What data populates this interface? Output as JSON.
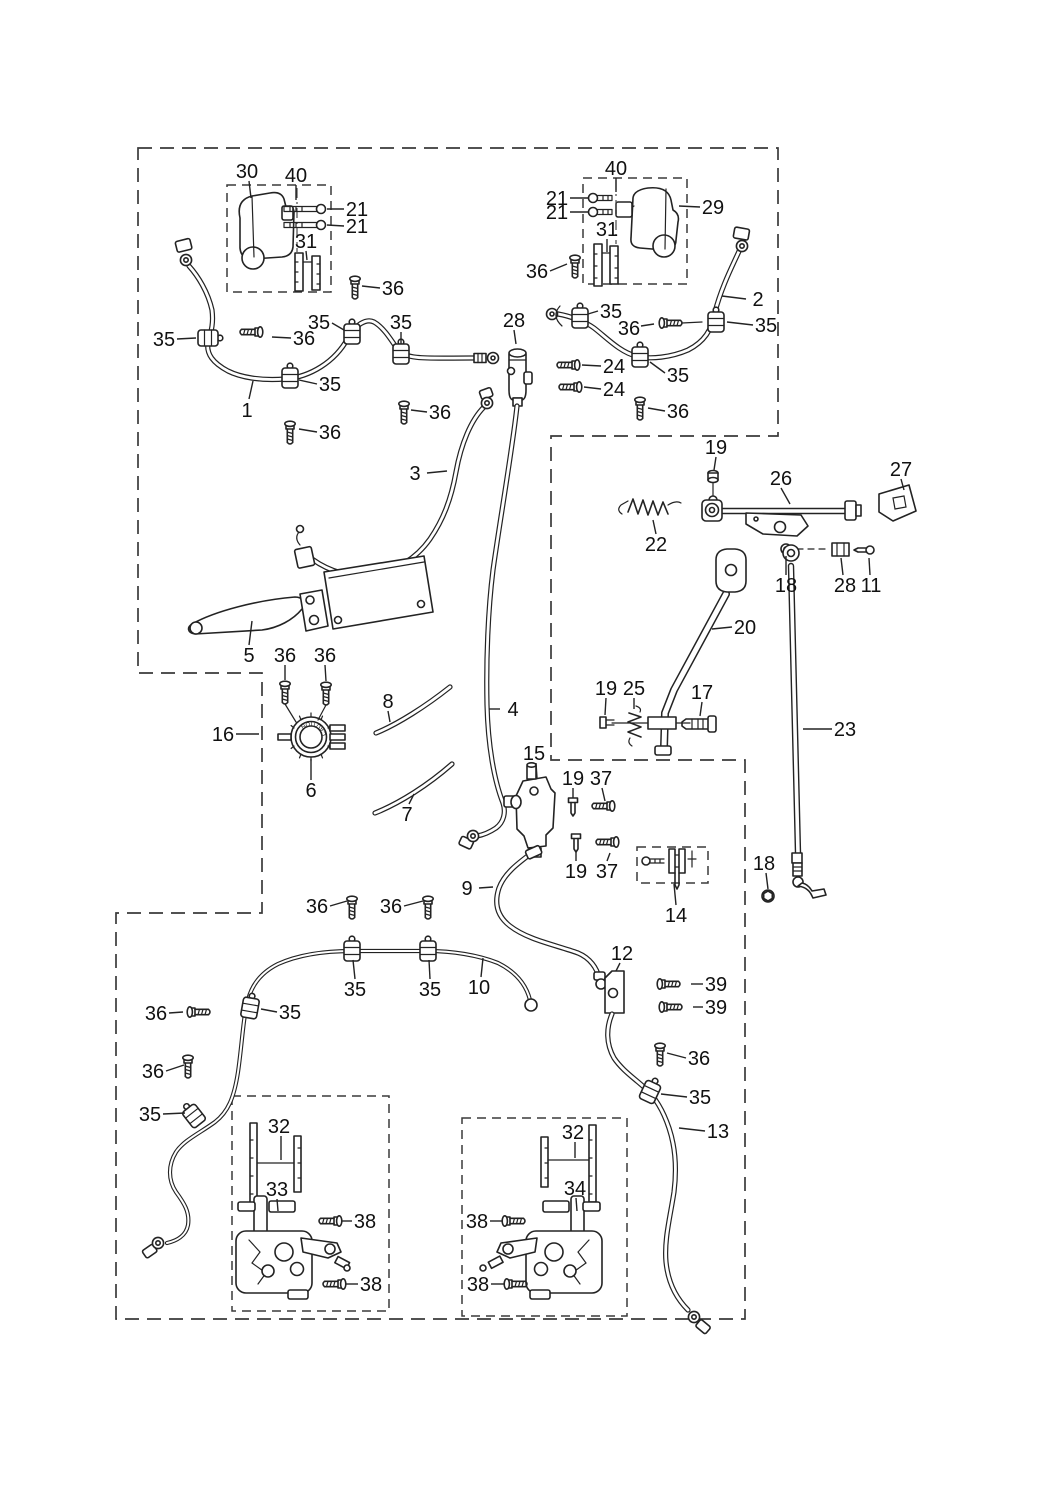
{
  "canvas": {
    "width": 1040,
    "height": 1500,
    "background": "#ffffff",
    "ink": "#232323",
    "label_color": "#111111",
    "label_font_px": 20
  },
  "cap": {
    "text": "CAUTION"
  },
  "callouts": [
    {
      "t": "30",
      "x": 247,
      "y": 171,
      "l": [
        249,
        181,
        251,
        198
      ]
    },
    {
      "t": "40",
      "x": 296,
      "y": 175,
      "l": [
        296,
        185,
        296,
        200
      ]
    },
    {
      "t": "21",
      "x": 357,
      "y": 209,
      "l": [
        344,
        209,
        327,
        209
      ]
    },
    {
      "t": "21",
      "x": 357,
      "y": 226,
      "l": [
        344,
        226,
        327,
        225
      ]
    },
    {
      "t": "31",
      "x": 306,
      "y": 241,
      "l": [
        306,
        251,
        307,
        260
      ]
    },
    {
      "t": "36",
      "x": 393,
      "y": 288,
      "l": [
        380,
        288,
        362,
        286
      ]
    },
    {
      "t": "35",
      "x": 319,
      "y": 322,
      "l": [
        332,
        323,
        344,
        330
      ]
    },
    {
      "t": "35",
      "x": 401,
      "y": 322,
      "l": [
        401,
        332,
        401,
        344
      ]
    },
    {
      "t": "36",
      "x": 440,
      "y": 412,
      "l": [
        427,
        412,
        411,
        410
      ]
    },
    {
      "t": "35",
      "x": 164,
      "y": 339,
      "l": [
        177,
        339,
        196,
        338
      ]
    },
    {
      "t": "36",
      "x": 304,
      "y": 338,
      "l": [
        291,
        338,
        272,
        337
      ]
    },
    {
      "t": "35",
      "x": 330,
      "y": 384,
      "l": [
        317,
        384,
        299,
        380
      ]
    },
    {
      "t": "1",
      "x": 247,
      "y": 410,
      "l": [
        249,
        399,
        253,
        381
      ]
    },
    {
      "t": "36",
      "x": 330,
      "y": 432,
      "l": [
        317,
        432,
        299,
        429
      ]
    },
    {
      "t": "28",
      "x": 514,
      "y": 320,
      "l": [
        514,
        330,
        516,
        344
      ]
    },
    {
      "t": "36",
      "x": 537,
      "y": 271,
      "l": [
        550,
        271,
        567,
        264
      ]
    },
    {
      "t": "35",
      "x": 611,
      "y": 311,
      "l": [
        598,
        311,
        588,
        314
      ]
    },
    {
      "t": "36",
      "x": 629,
      "y": 328,
      "l": [
        641,
        326,
        654,
        324
      ]
    },
    {
      "t": "35",
      "x": 766,
      "y": 325,
      "l": [
        753,
        325,
        727,
        322
      ]
    },
    {
      "t": "2",
      "x": 758,
      "y": 299,
      "l": [
        746,
        299,
        722,
        296
      ]
    },
    {
      "t": "24",
      "x": 614,
      "y": 366,
      "l": [
        601,
        366,
        582,
        365
      ]
    },
    {
      "t": "24",
      "x": 614,
      "y": 389,
      "l": [
        601,
        389,
        584,
        387
      ]
    },
    {
      "t": "35",
      "x": 678,
      "y": 375,
      "l": [
        665,
        373,
        650,
        362
      ]
    },
    {
      "t": "36",
      "x": 678,
      "y": 411,
      "l": [
        665,
        411,
        648,
        408
      ]
    },
    {
      "t": "40",
      "x": 616,
      "y": 168,
      "l": [
        616,
        178,
        616,
        192
      ]
    },
    {
      "t": "21",
      "x": 557,
      "y": 198,
      "l": [
        570,
        198,
        589,
        198
      ]
    },
    {
      "t": "21",
      "x": 557,
      "y": 212,
      "l": [
        570,
        212,
        589,
        212
      ]
    },
    {
      "t": "29",
      "x": 713,
      "y": 207,
      "l": [
        700,
        207,
        679,
        206
      ]
    },
    {
      "t": "31",
      "x": 607,
      "y": 229,
      "l": [
        607,
        239,
        607,
        252
      ]
    },
    {
      "t": "19",
      "x": 716,
      "y": 447,
      "l": [
        716,
        457,
        714,
        470
      ]
    },
    {
      "t": "26",
      "x": 781,
      "y": 478,
      "l": [
        781,
        488,
        790,
        504
      ]
    },
    {
      "t": "27",
      "x": 901,
      "y": 469,
      "l": [
        901,
        479,
        904,
        490
      ]
    },
    {
      "t": "22",
      "x": 656,
      "y": 544,
      "l": [
        656,
        534,
        653,
        520
      ]
    },
    {
      "t": "18",
      "x": 786,
      "y": 585,
      "l": [
        786,
        575,
        786,
        556
      ]
    },
    {
      "t": "28",
      "x": 845,
      "y": 585,
      "l": [
        843,
        575,
        841,
        558
      ]
    },
    {
      "t": "11",
      "x": 871,
      "y": 585,
      "l": [
        870,
        575,
        869,
        558
      ]
    },
    {
      "t": "20",
      "x": 745,
      "y": 627,
      "l": [
        732,
        627,
        712,
        629
      ]
    },
    {
      "t": "23",
      "x": 845,
      "y": 729,
      "l": [
        832,
        729,
        803,
        729
      ]
    },
    {
      "t": "19",
      "x": 606,
      "y": 688,
      "l": [
        606,
        698,
        605,
        715
      ]
    },
    {
      "t": "25",
      "x": 634,
      "y": 688,
      "l": [
        634,
        698,
        634,
        709
      ]
    },
    {
      "t": "17",
      "x": 702,
      "y": 692,
      "l": [
        702,
        702,
        700,
        716
      ]
    },
    {
      "t": "18",
      "x": 764,
      "y": 863,
      "l": [
        766,
        873,
        768,
        889
      ]
    },
    {
      "t": "3",
      "x": 415,
      "y": 473,
      "l": [
        427,
        473,
        447,
        471
      ]
    },
    {
      "t": "16",
      "x": 223,
      "y": 734,
      "l": [
        236,
        734,
        259,
        734
      ]
    },
    {
      "t": "5",
      "x": 249,
      "y": 655,
      "l": [
        249,
        645,
        252,
        621
      ]
    },
    {
      "t": "36",
      "x": 285,
      "y": 655,
      "l": [
        285,
        665,
        285,
        680
      ]
    },
    {
      "t": "36",
      "x": 325,
      "y": 655,
      "l": [
        325,
        665,
        326,
        681
      ]
    },
    {
      "t": "6",
      "x": 311,
      "y": 790,
      "l": [
        311,
        780,
        311,
        759
      ]
    },
    {
      "t": "8",
      "x": 388,
      "y": 701,
      "l": [
        388,
        711,
        390,
        722
      ]
    },
    {
      "t": "7",
      "x": 407,
      "y": 814,
      "l": [
        409,
        804,
        414,
        794
      ]
    },
    {
      "t": "4",
      "x": 513,
      "y": 709,
      "l": [
        500,
        709,
        489,
        709
      ]
    },
    {
      "t": "15",
      "x": 534,
      "y": 753,
      "l": [
        536,
        763,
        537,
        778
      ]
    },
    {
      "t": "19",
      "x": 573,
      "y": 778,
      "l": [
        573,
        788,
        573,
        798
      ]
    },
    {
      "t": "37",
      "x": 601,
      "y": 778,
      "l": [
        602,
        788,
        605,
        801
      ]
    },
    {
      "t": "19",
      "x": 576,
      "y": 871,
      "l": [
        576,
        861,
        576,
        852
      ]
    },
    {
      "t": "37",
      "x": 607,
      "y": 871,
      "l": [
        607,
        861,
        610,
        853
      ]
    },
    {
      "t": "14",
      "x": 676,
      "y": 915,
      "l": [
        676,
        905,
        674,
        884
      ]
    },
    {
      "t": "9",
      "x": 467,
      "y": 888,
      "l": [
        479,
        888,
        493,
        887
      ]
    },
    {
      "t": "12",
      "x": 622,
      "y": 953,
      "l": [
        620,
        963,
        616,
        971
      ]
    },
    {
      "t": "39",
      "x": 716,
      "y": 984,
      "l": [
        703,
        984,
        691,
        984
      ]
    },
    {
      "t": "39",
      "x": 716,
      "y": 1007,
      "l": [
        703,
        1007,
        693,
        1007
      ]
    },
    {
      "t": "10",
      "x": 479,
      "y": 987,
      "l": [
        481,
        977,
        483,
        958
      ]
    },
    {
      "t": "36",
      "x": 317,
      "y": 906,
      "l": [
        330,
        906,
        347,
        901
      ]
    },
    {
      "t": "36",
      "x": 391,
      "y": 906,
      "l": [
        404,
        906,
        423,
        901
      ]
    },
    {
      "t": "35",
      "x": 355,
      "y": 989,
      "l": [
        355,
        979,
        353,
        960
      ]
    },
    {
      "t": "35",
      "x": 430,
      "y": 989,
      "l": [
        430,
        979,
        429,
        960
      ]
    },
    {
      "t": "36",
      "x": 156,
      "y": 1013,
      "l": [
        169,
        1013,
        183,
        1012
      ]
    },
    {
      "t": "35",
      "x": 290,
      "y": 1012,
      "l": [
        277,
        1012,
        261,
        1009
      ]
    },
    {
      "t": "36",
      "x": 153,
      "y": 1071,
      "l": [
        166,
        1071,
        184,
        1065
      ]
    },
    {
      "t": "35",
      "x": 150,
      "y": 1114,
      "l": [
        163,
        1114,
        185,
        1113
      ]
    },
    {
      "t": "32",
      "x": 279,
      "y": 1126,
      "l": [
        281,
        1136,
        281,
        1160
      ]
    },
    {
      "t": "33",
      "x": 277,
      "y": 1189,
      "l": [
        277,
        1199,
        278,
        1211
      ]
    },
    {
      "t": "38",
      "x": 365,
      "y": 1221,
      "l": [
        352,
        1221,
        342,
        1221
      ]
    },
    {
      "t": "38",
      "x": 371,
      "y": 1284,
      "l": [
        358,
        1284,
        346,
        1284
      ]
    },
    {
      "t": "36",
      "x": 699,
      "y": 1058,
      "l": [
        686,
        1058,
        667,
        1053
      ]
    },
    {
      "t": "35",
      "x": 700,
      "y": 1097,
      "l": [
        687,
        1097,
        661,
        1094
      ]
    },
    {
      "t": "13",
      "x": 718,
      "y": 1131,
      "l": [
        705,
        1131,
        679,
        1128
      ]
    },
    {
      "t": "32",
      "x": 573,
      "y": 1132,
      "l": [
        575,
        1142,
        575,
        1158
      ]
    },
    {
      "t": "34",
      "x": 575,
      "y": 1188,
      "l": [
        576,
        1198,
        577,
        1211
      ]
    },
    {
      "t": "38",
      "x": 477,
      "y": 1221,
      "l": [
        490,
        1221,
        502,
        1221
      ]
    },
    {
      "t": "38",
      "x": 478,
      "y": 1284,
      "l": [
        491,
        1284,
        504,
        1284
      ]
    }
  ]
}
